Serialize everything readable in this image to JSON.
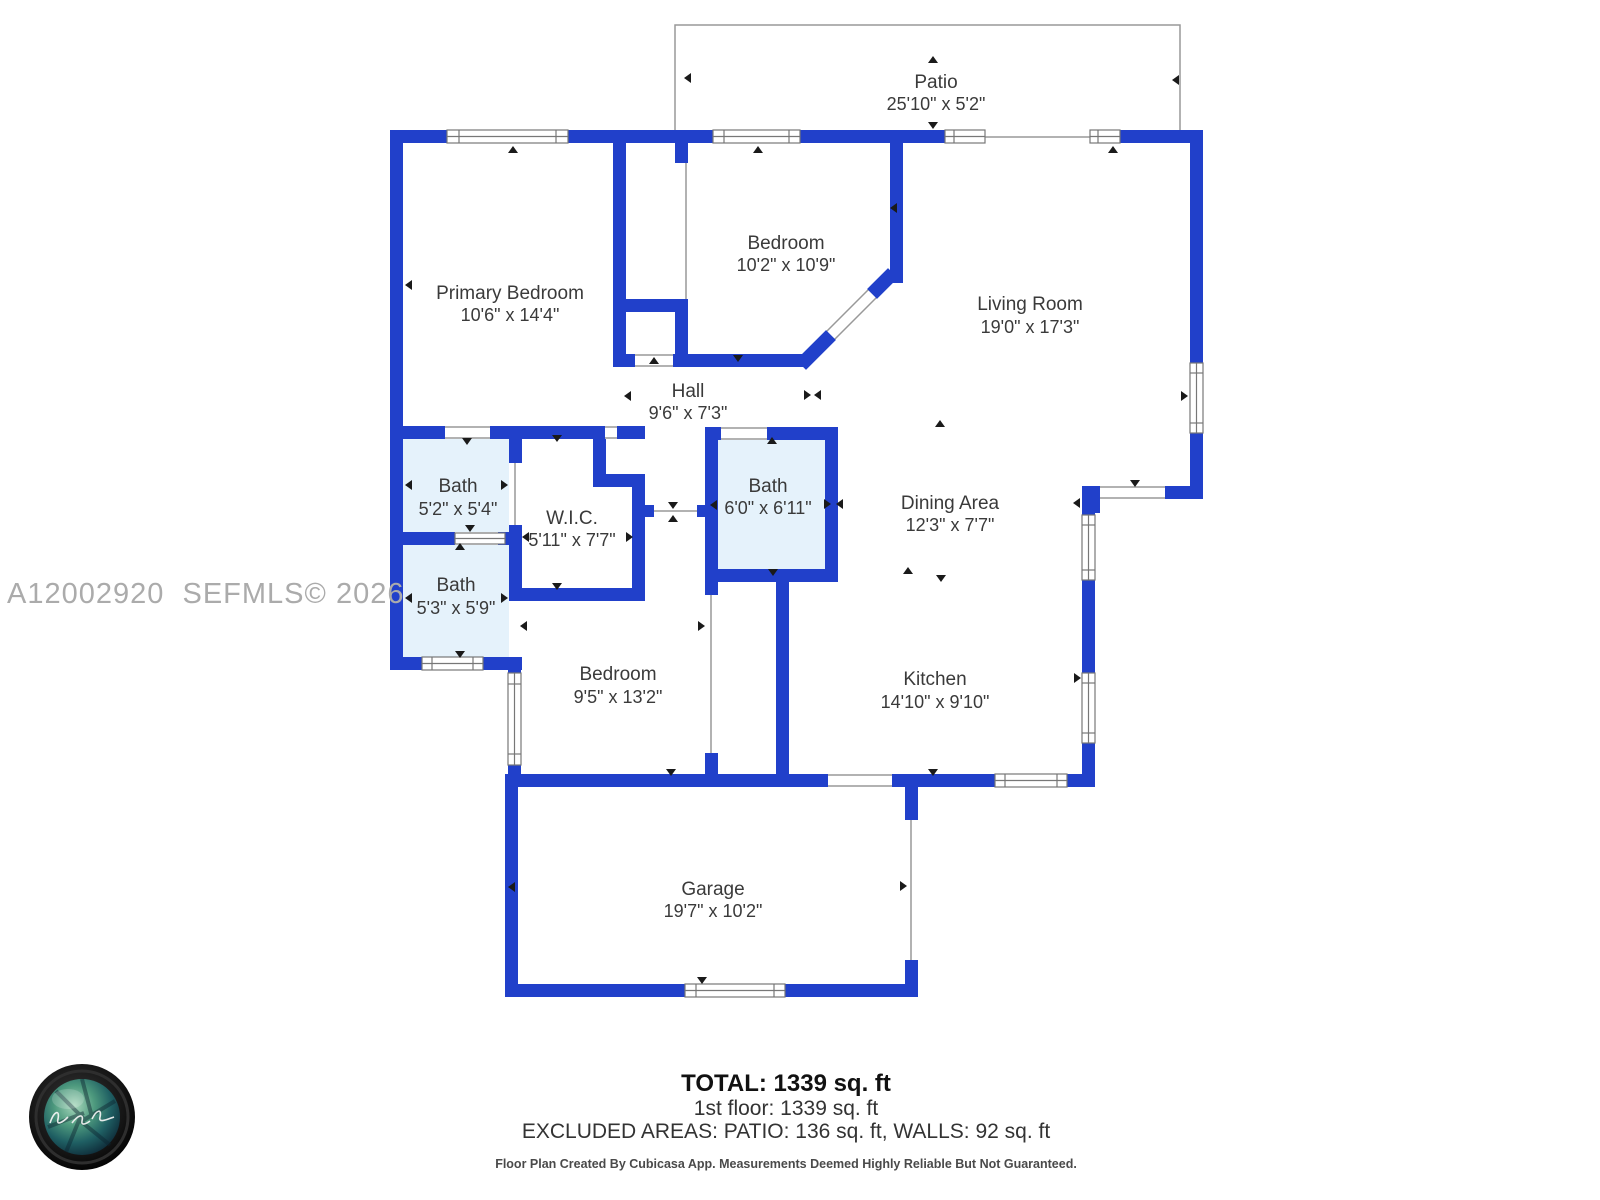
{
  "watermark": "A12002920  SEFMLS© 2026",
  "rooms": [
    {
      "name": "Patio",
      "dims": "25'10\" x 5'2\""
    },
    {
      "name": "Primary Bedroom",
      "dims": "10'6\" x 14'4\""
    },
    {
      "name": "Bedroom",
      "dims": "10'2\" x 10'9\""
    },
    {
      "name": "Living Room",
      "dims": "19'0\" x 17'3\""
    },
    {
      "name": "Hall",
      "dims": "9'6\" x 7'3\""
    },
    {
      "name": "Bath",
      "dims": "5'2\" x 5'4\""
    },
    {
      "name": "W.I.C.",
      "dims": "5'11\" x 7'7\""
    },
    {
      "name": "Bath",
      "dims": "6'0\" x 6'11\""
    },
    {
      "name": "Dining Area",
      "dims": "12'3\" x 7'7\""
    },
    {
      "name": "Bath",
      "dims": "5'3\" x 5'9\""
    },
    {
      "name": "Bedroom",
      "dims": "9'5\" x 13'2\""
    },
    {
      "name": "Kitchen",
      "dims": "14'10\" x 9'10\""
    },
    {
      "name": "Garage",
      "dims": "19'7\" x 10'2\""
    }
  ],
  "summary": {
    "total": "TOTAL: 1339 sq. ft",
    "first_floor": "1st floor: 1339 sq. ft",
    "excluded": "EXCLUDED AREAS: PATIO: 136 sq. ft, WALLS: 92 sq. ft",
    "disclaimer": "Floor Plan Created By Cubicasa App. Measurements Deemed Highly Reliable But Not Guaranteed."
  },
  "colors": {
    "wall": "#2140ca",
    "bath_fill": "#e5f2fb",
    "line": "#999999",
    "text": "#3a3a3a",
    "watermark": "#ababab",
    "marker": "#1a1a1a"
  }
}
